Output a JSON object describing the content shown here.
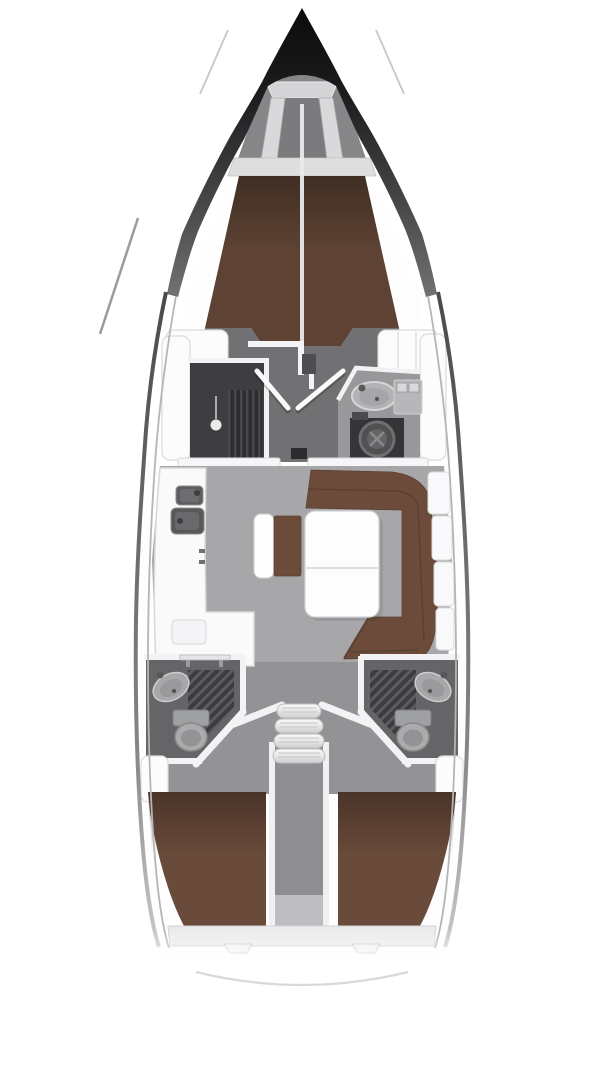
{
  "app": {
    "name": "yacht-interior-floor-plan",
    "view": "top-down, bow at top",
    "vessel_type": "sailing yacht monohull, three-cabin layout"
  },
  "palette": {
    "hull_tip_black": "#0b0b0c",
    "hull_line_gray": "#4e4e50",
    "deck_white": "#fefefe",
    "salon_floor_gray": "#a7a7a9",
    "cabin_floor_gray": "#717173",
    "aft_zone_gray": "#939395",
    "head_floor_gray": "#656567",
    "foredeck_gray": "#868688",
    "cushion_brown": "#6c4b3b",
    "berth_brown": "#6a4a3a",
    "vberth_brown": "#5e4334",
    "furniture_white": "#fafafb",
    "wall_white": "#f3f3f5",
    "fixture_gray": "#ababad",
    "corridor_gray": "#8f8f91",
    "appliance_dark": "#353537",
    "grate_dark": "#3c3c3e",
    "ledge_gray": "#ebebed"
  },
  "regions": {
    "bow": {
      "features": [
        "anchor-locker",
        "a-frame",
        "mast-line"
      ]
    },
    "forward_cabin": {
      "berth": "v-berth-double",
      "features": [
        "wardrobe",
        "double-doors",
        "side-shelves"
      ]
    },
    "forward_head": {
      "fixtures": [
        "washbasin",
        "faucet",
        "cabinet",
        "round-appliance"
      ]
    },
    "salon": {
      "features": [
        "u-shaped-settee",
        "salon-table",
        "center-bench"
      ]
    },
    "galley": {
      "fixtures": [
        "double-sink",
        "l-shaped-counter",
        "worktop-inset",
        "chart-table"
      ]
    },
    "companionway": {
      "steps_count": 4,
      "features": [
        "engine-corridor"
      ]
    },
    "aft_head_port": {
      "fixtures": [
        "washbasin",
        "toilet",
        "shower-grate"
      ]
    },
    "aft_head_starboard": {
      "fixtures": [
        "washbasin",
        "toilet",
        "shower-grate"
      ]
    },
    "aft_cabin_port": {
      "berth": "double-berth"
    },
    "aft_cabin_starboard": {
      "berth": "double-berth"
    },
    "stern": {
      "features": [
        "aft-ledge",
        "transom-arc"
      ]
    }
  }
}
